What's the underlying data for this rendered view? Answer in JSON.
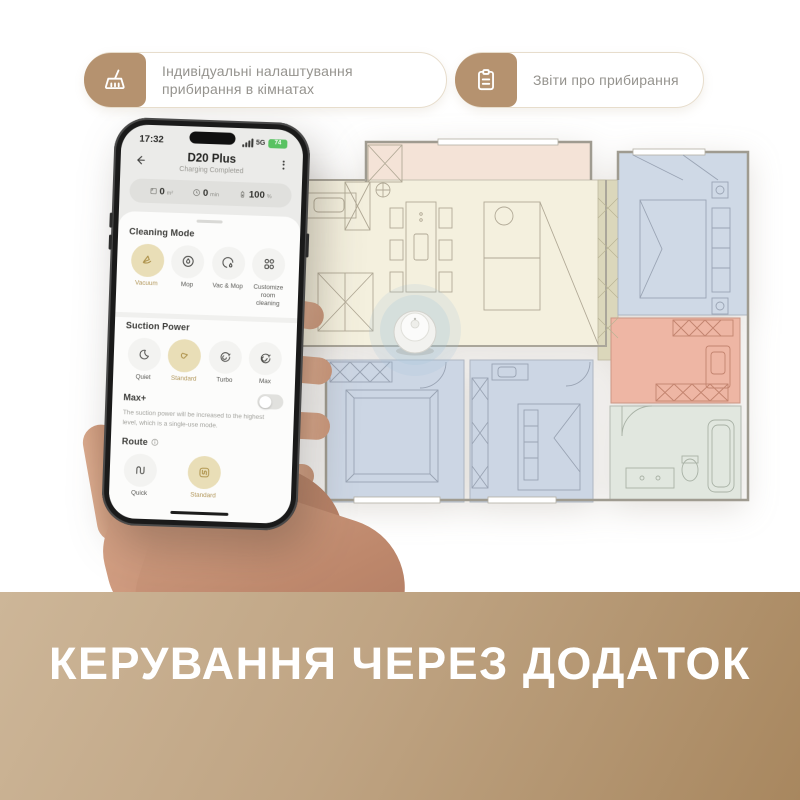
{
  "badges": [
    {
      "icon": "broom-icon",
      "label": "Індивідуальні налаштування прибирання в кімнатах"
    },
    {
      "icon": "clipboard-icon",
      "label": "Звіти про прибирання"
    }
  ],
  "phone": {
    "status_bar": {
      "time": "17:32",
      "network": "5G",
      "battery_percent": "74"
    },
    "header": {
      "title": "D20 Plus",
      "subtitle": "Charging Completed"
    },
    "stats": [
      {
        "icon": "area-icon",
        "value": "0",
        "unit": "m²"
      },
      {
        "icon": "time-icon",
        "value": "0",
        "unit": "min"
      },
      {
        "icon": "battery-icon",
        "value": "100",
        "unit": "%"
      }
    ],
    "cleaning_mode": {
      "title": "Cleaning Mode",
      "options": [
        {
          "label": "Vacuum",
          "icon": "vacuum-icon",
          "selected": true
        },
        {
          "label": "Mop",
          "icon": "mop-icon",
          "selected": false
        },
        {
          "label": "Vac & Mop",
          "icon": "vac-and-mop-icon",
          "selected": false
        },
        {
          "label": "Customize room cleaning",
          "icon": "room-grid-icon",
          "selected": false
        }
      ]
    },
    "suction_power": {
      "title": "Suction Power",
      "options": [
        {
          "label": "Quiet",
          "icon": "quiet-icon",
          "selected": false
        },
        {
          "label": "Standard",
          "icon": "standard-fan-icon",
          "selected": true
        },
        {
          "label": "Turbo",
          "icon": "turbo-icon",
          "selected": false
        },
        {
          "label": "Max",
          "icon": "max-icon",
          "selected": false
        }
      ]
    },
    "max_plus": {
      "label": "Max+",
      "enabled": false,
      "description": "The suction power will be increased to the highest level, which is a single-use mode."
    },
    "route": {
      "title": "Route",
      "options": [
        {
          "label": "Quick",
          "icon": "quick-route-icon",
          "selected": false
        },
        {
          "label": "Standard",
          "icon": "standard-route-icon",
          "selected": true
        }
      ]
    }
  },
  "banner": {
    "title": "КЕРУВАННЯ ЧЕРЕЗ ДОДАТОК"
  },
  "colors": {
    "accent_tan": "#b5926f",
    "selected_chip_bg": "#e9deb7",
    "selected_chip_text": "#ab8f45",
    "banner_gradient_start": "#cdb698",
    "banner_gradient_end": "#a8875f",
    "status_battery_green": "#59c262"
  }
}
